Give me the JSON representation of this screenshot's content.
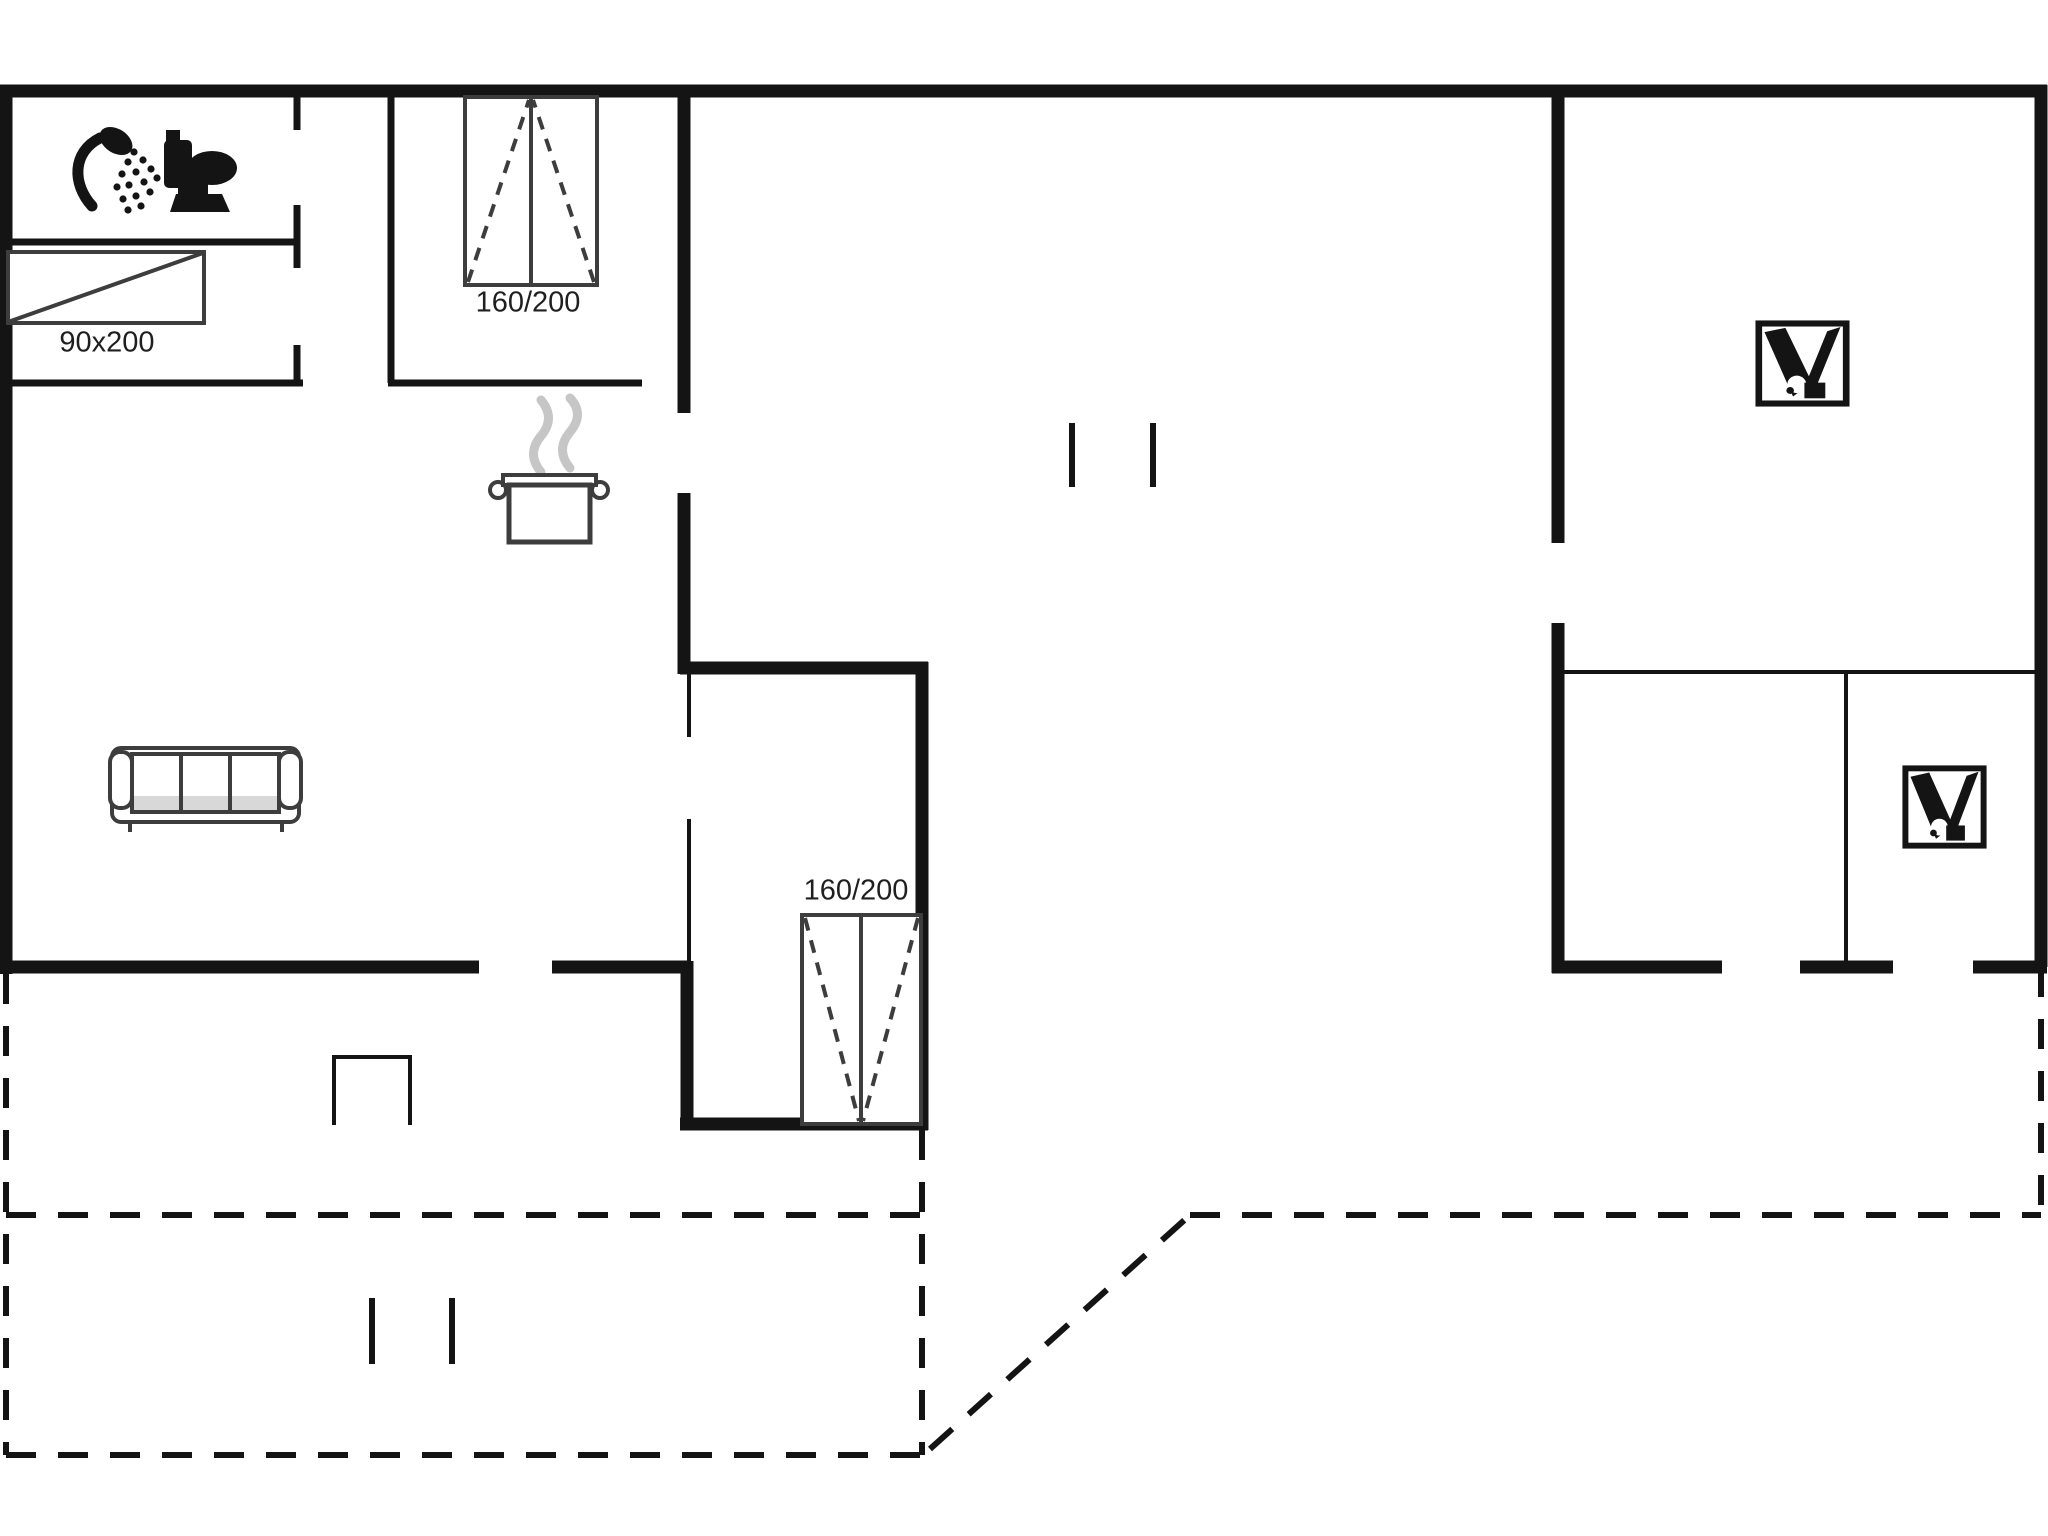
{
  "drawing_type": "floor-plan",
  "palette": {
    "background": "#ffffff",
    "wall": "#141414",
    "furniture_line": "#3d3d3d",
    "steam": "#c6c6c6",
    "label_text": "#1f1f1f",
    "sofa_shade": "#d8d8d8"
  },
  "beds": {
    "single": {
      "size_label": "90x200"
    },
    "double_top": {
      "size_label": "160/200"
    },
    "double_annex": {
      "size_label": "160/200"
    }
  },
  "icon_names": [
    "shower-icon",
    "toilet-icon",
    "cooking-pot-icon",
    "sofa-icon",
    "single-bed-icon",
    "double-bed-icon",
    "double-bed-icon",
    "bunk-bed-icon",
    "bunk-bed-icon"
  ]
}
